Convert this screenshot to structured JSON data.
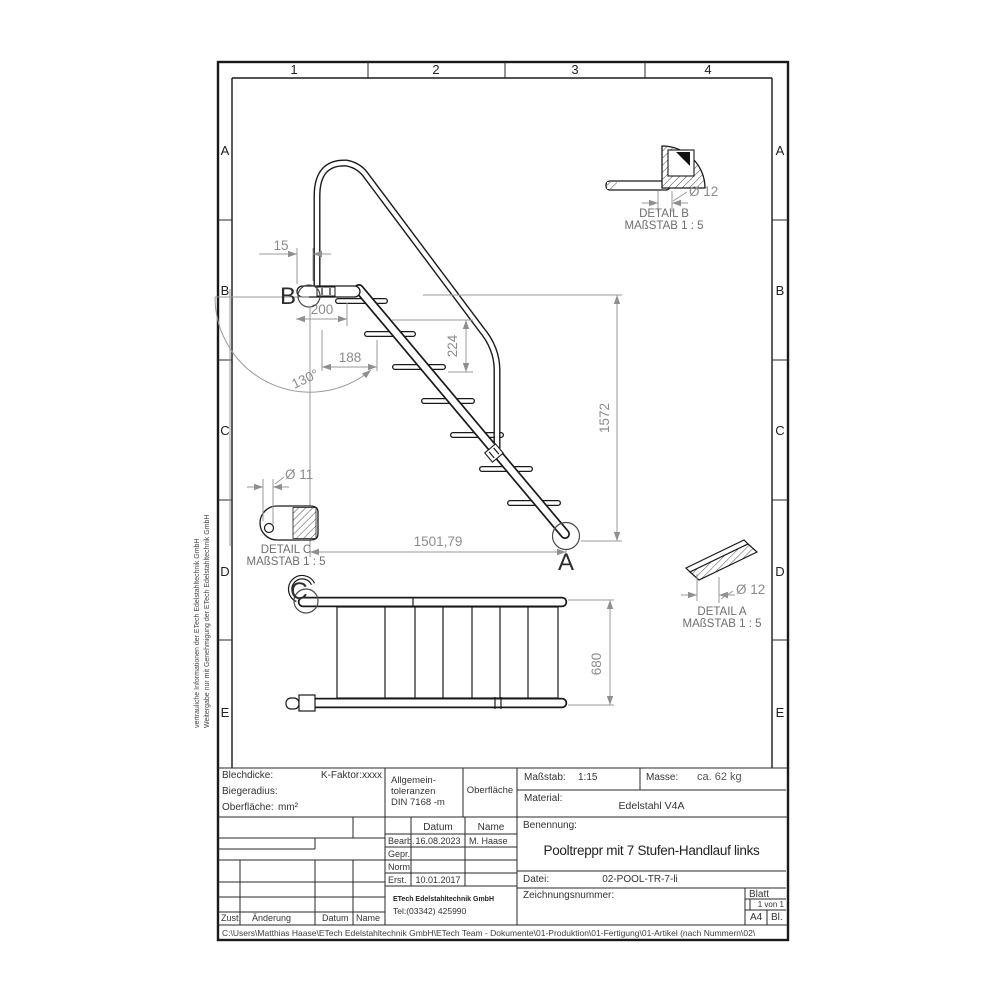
{
  "ruler": {
    "cols": [
      "1",
      "2",
      "3",
      "4"
    ],
    "rows": [
      "A",
      "B",
      "C",
      "D",
      "E"
    ]
  },
  "views": {
    "elevation": {
      "dims": {
        "d15": "15",
        "d200": "200",
        "d188": "188",
        "d224": "224",
        "angle": "130°",
        "d1572": "1572",
        "d1501": "1501,79"
      },
      "markers": {
        "a": "A",
        "b": "B"
      }
    },
    "plan": {
      "dims": {
        "d680": "680"
      },
      "markers": {
        "c": "C"
      }
    },
    "detail_b": {
      "title": "DETAIL B",
      "scale": "MAßSTAB 1 : 5",
      "dia": "Ø 12"
    },
    "detail_a": {
      "title": "DETAIL A",
      "scale": "MAßSTAB 1 : 5",
      "dia": "Ø 12"
    },
    "detail_c": {
      "title": "DETAIL C",
      "scale": "MAßSTAB 1 : 5",
      "dia": "Ø 11"
    }
  },
  "titleblock": {
    "blechdicke_label": "Blechdicke:",
    "k_faktor": "K-Faktor:xxxx",
    "biegeradius_label": "Biegeradius:",
    "oberflaeche_label": "Oberfläche:",
    "oberflaeche_value": "mm²",
    "tol_line1": "Allgemein-",
    "tol_line2": "toleranzen",
    "tol_line3": "DIN 7168 -m",
    "oberflaeche_header": "Oberfläche",
    "massstab_label": "Maßstab:",
    "massstab_value": "1:15",
    "masse_label": "Masse:",
    "masse_value": "ca. 62 kg",
    "material_label": "Material:",
    "material_value": "Edelstahl V4A",
    "benennung_label": "Benennung:",
    "benennung_value": "Pooltreppr mit 7 Stufen-Handlauf links",
    "datei_label": "Datei:",
    "datei_value": "02-POOL-TR-7-li",
    "zeichnungsnummer_label": "Zeichnungsnummer:",
    "blatt_label": "Blatt",
    "blatt_value": "1 von 1",
    "format_value": "A4",
    "bl_label": "Bl.",
    "approval": {
      "col_datum": "Datum",
      "col_name": "Name",
      "rows": [
        {
          "label": "Bearb.",
          "datum": "16.08.2023",
          "name": "M. Haase"
        },
        {
          "label": "Gepr.",
          "datum": "",
          "name": ""
        },
        {
          "label": "Norm",
          "datum": "",
          "name": ""
        },
        {
          "label": "Erst.",
          "datum": "10.01.2017",
          "name": ""
        }
      ]
    },
    "company_name": "ETech Edelstahltechnik GmbH",
    "company_tel": "Tel:(03342) 425990"
  },
  "revision": {
    "zust": "Zust.",
    "aenderung": "Änderung",
    "datum": "Datum",
    "name": "Name"
  },
  "footer": {
    "path": "C:\\Users\\Matthias Haase\\ETech Edelstahltechnik GmbH\\ETech Team - Dokumente\\01-Produktion\\01-Fertigung\\01-Artikel (nach Nummern\\02\\"
  },
  "confidential": {
    "line1": "vertrauliche Informationen der ETech Edelstahltechnik GmbH",
    "line2": "Weitergabe nur mit Genehmigung der  ETech Edelstahltechnik GmbH"
  }
}
